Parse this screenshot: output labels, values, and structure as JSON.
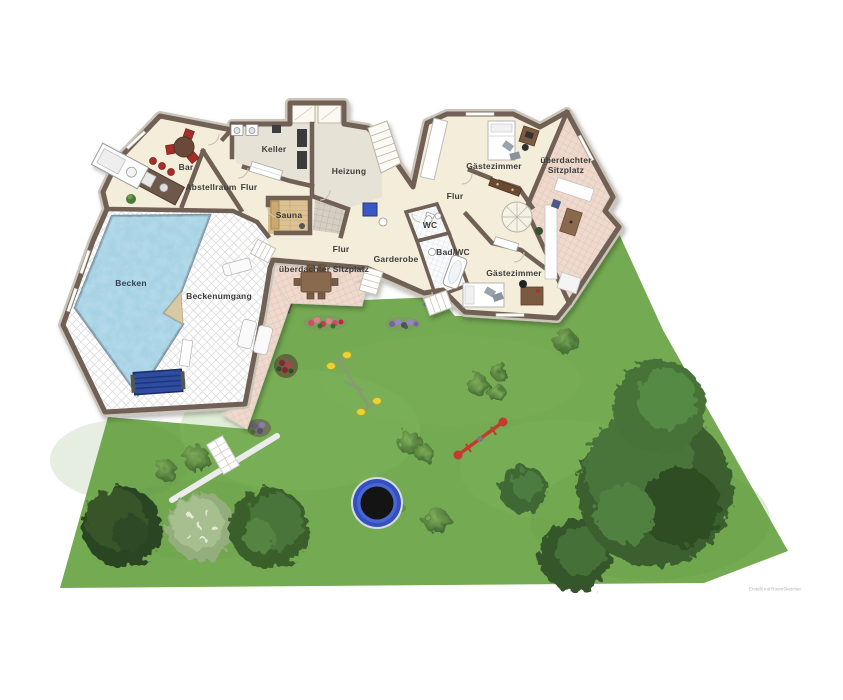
{
  "rooms": {
    "bar": "Bar",
    "abstellraum": "Abstellraum",
    "keller": "Keller",
    "flur_keller": "Flur",
    "heizung": "Heizung",
    "sauna": "Sauna",
    "becken": "Becken",
    "beckenumgang": "Beckenumgang",
    "flur_mitte": "Flur",
    "flur_links": "Flur",
    "wc": "WC",
    "bad_wc": "Bad/WC",
    "garderobe": "Garderobe",
    "sitzplatz_links": "überdachter Sitzplatz",
    "gaestezimmer_oben": "Gästezimmer",
    "gaestezimmer_unten": "Gästezimmer",
    "sitzplatz_rechts": "überdachter Sitzplatz"
  },
  "watermark": "Erstellt mit RoomSketcher",
  "colors": {
    "wall": "#6f6155",
    "floor_cream": "#f4edda",
    "floor_gray": "#e7e2d6",
    "pool_water": "#a9d4e6",
    "walkway_tile": "#ffffff",
    "terrace_pink": "#eed9cc",
    "sauna_wood": "#dcc192",
    "grass": "#74aa52",
    "tree_green": "#3b5f2e",
    "trampoline_blue": "#3350c0",
    "swing_yellow": "#e8d23a",
    "seesaw_red": "#c23b2e"
  },
  "garden": {
    "items": [
      "trees",
      "bushes",
      "flower-beds",
      "trampoline",
      "swing-set",
      "seesaw",
      "garden-path",
      "pool-cover-roller",
      "sun-loungers",
      "dining-set"
    ]
  }
}
